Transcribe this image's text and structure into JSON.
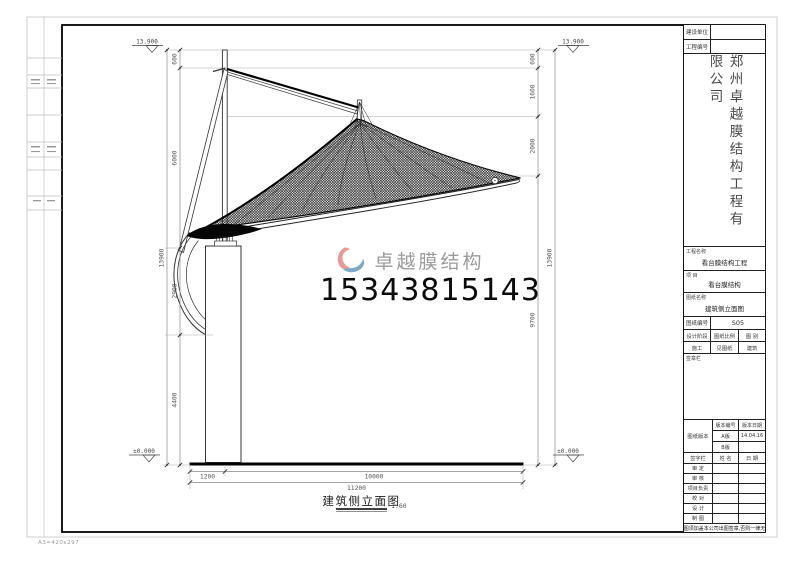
{
  "page": {
    "size_label": "A3=420x297"
  },
  "drawing": {
    "title": "建筑侧立面图",
    "scale": "1:60",
    "levels": {
      "top": "13.900",
      "bottom": "±0.000"
    },
    "dims": {
      "left_outer": "13900",
      "left_chain": [
        "600",
        "6000",
        "2900",
        "4400"
      ],
      "right_chain": [
        "600",
        "1600",
        "2000",
        "9700"
      ],
      "right_outer": "13900",
      "bottom_chain": [
        "1200",
        "10000"
      ],
      "bottom_total": "11200"
    }
  },
  "watermark": {
    "brand": "卓越膜结构",
    "phone": "15343815143",
    "logo_pink": "#e89a96",
    "logo_blue": "#7fa9c9"
  },
  "titleblock": {
    "company_vertical": "郑州卓越膜结构工程有限公司",
    "fields": {
      "construction_unit_label": "建设单位",
      "project_no_label": "工程编号",
      "project_name_label": "工程名称",
      "project_name": "看台膜结构工程",
      "item_label": "项 目",
      "item": "看台膜结构",
      "drawing_name_label": "图纸名称",
      "drawing_name": "建筑侧立面图",
      "drawing_no_label": "图纸编号",
      "drawing_no": "S05",
      "stage_label": "设计阶段",
      "scale_label": "图纸比例",
      "category_label": "图 别",
      "stage": "施工",
      "scale_value": "见图纸",
      "category": "建筑",
      "seal_label": "签章栏",
      "version_label": "图纸版本",
      "version_no_label": "版本编号",
      "version_date_label": "版本日期",
      "version_a": "A版",
      "version_a_date": "14.04.16",
      "version_b": "B版",
      "sign_label": "签字栏",
      "name_label": "姓 名",
      "date_label": "日 期",
      "rows": [
        "审 定",
        "审 核",
        "项目负责",
        "校 对",
        "设 计",
        "制 图"
      ],
      "note": "本图须加盖本公司出图签章,否则一律无效"
    }
  }
}
